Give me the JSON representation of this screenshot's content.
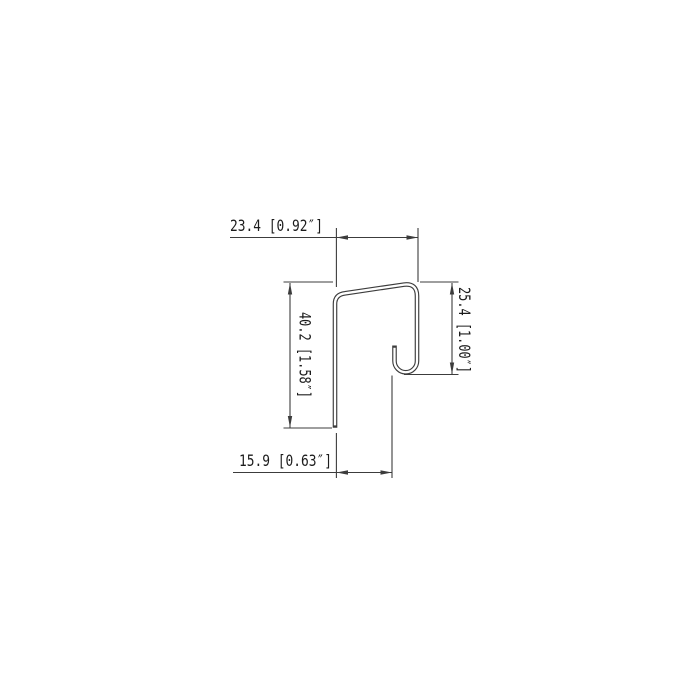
{
  "drawing": {
    "background": "#ffffff",
    "line_color": "#3c3c3c",
    "text_color": "#1c1c1c",
    "profile": {
      "description": "J-channel sheet metal profile cross-section with upturned hook lip"
    },
    "dimensions": {
      "top_width": {
        "label": "23.4 [0.92″]",
        "mm": 23.4,
        "inches": 0.92
      },
      "right_height": {
        "label": "25.4 [1.00″]",
        "mm": 25.4,
        "inches": 1.0
      },
      "left_height": {
        "label": "40.2 [1.58″]",
        "mm": 40.2,
        "inches": 1.58
      },
      "bottom_width": {
        "label": "15.9 [0.63″]",
        "mm": 15.9,
        "inches": 0.63
      }
    }
  }
}
